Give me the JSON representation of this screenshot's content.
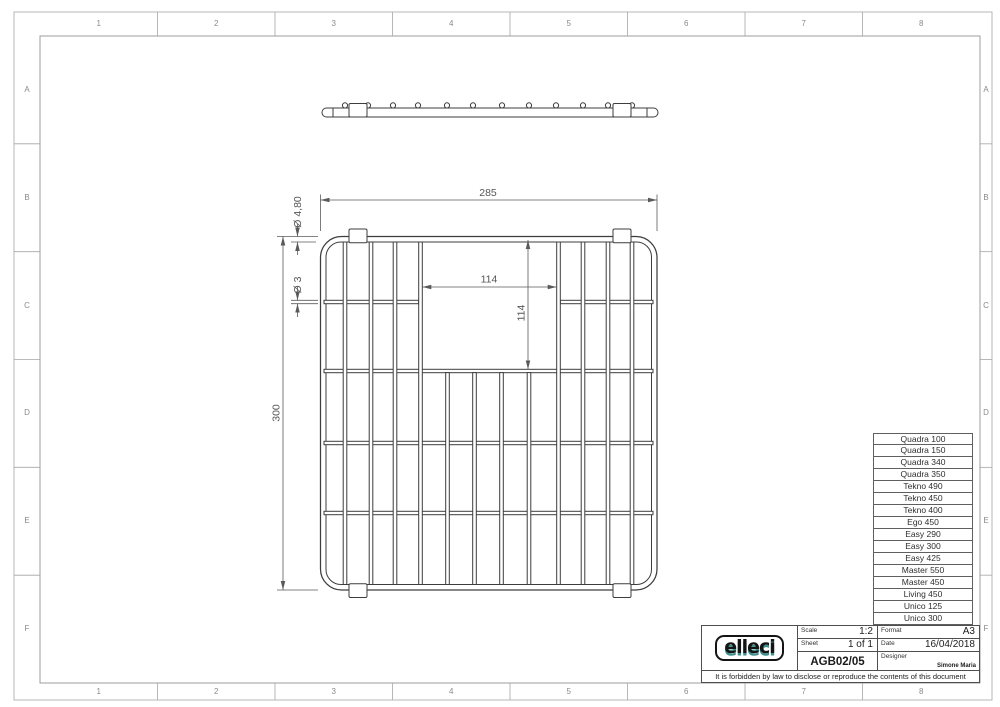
{
  "frame": {
    "columns": [
      "1",
      "2",
      "3",
      "4",
      "5",
      "6",
      "7",
      "8"
    ],
    "rows": [
      "A",
      "B",
      "C",
      "D",
      "E",
      "F"
    ]
  },
  "drawing": {
    "dims": {
      "width": "285",
      "height": "300",
      "opening_width": "114",
      "opening_height": "114",
      "wire_outer": "Ø 4,80",
      "wire_inner": "Ø 3"
    }
  },
  "models": {
    "items": [
      "Quadra 100",
      "Quadra 150",
      "Quadra 340",
      "Quadra 350",
      "Tekno 490",
      "Tekno 450",
      "Tekno 400",
      "Ego 450",
      "Easy 290",
      "Easy 300",
      "Easy 425",
      "Master 550",
      "Master 450",
      "Living 450",
      "Unico 125",
      "Unico 300"
    ]
  },
  "title_block": {
    "logo_text": "elleci",
    "scale_label": "Scale",
    "scale_value": "1:2",
    "format_label": "Format",
    "format_value": "A3",
    "sheet_label": "Sheet",
    "sheet_value": "1 of 1",
    "date_label": "Date",
    "date_value": "16/04/2018",
    "doc_number": "AGB02/05",
    "designer_label": "Designer",
    "designer_value": "Simone Maria",
    "legal": "It is forbidden by law to disclose or reproduce the contents of this document"
  },
  "colors": {
    "line": "#3d3d3d",
    "dim": "#5a5a5a",
    "border": "#9c9c9c",
    "logo_teal": "#3f8f8d"
  }
}
